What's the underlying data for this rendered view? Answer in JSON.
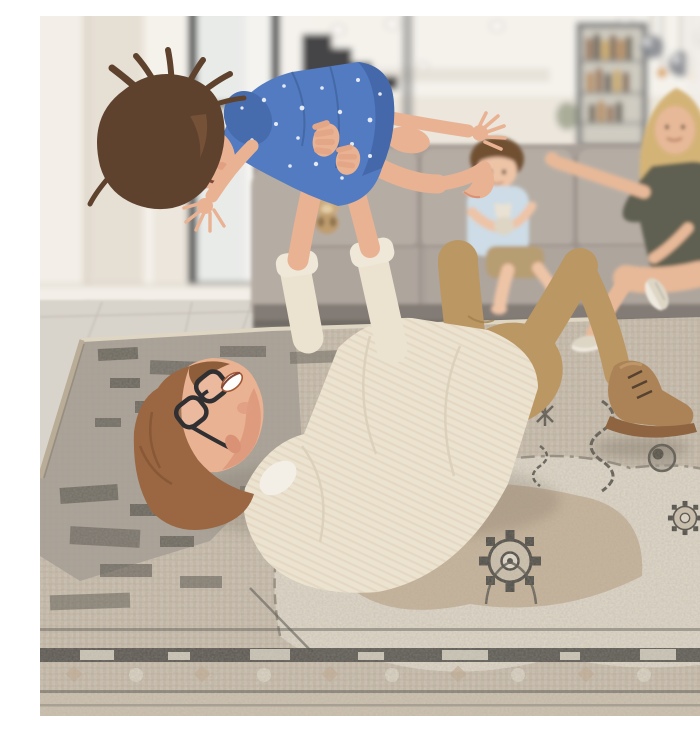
{
  "scene": {
    "caption": "Lifestyle photo: a father lies on his back on a distressed beige-and-grey vintage-style area rug, lifting his laughing daughter in a blue polka-dot dress into the air; a smiling blonde mother and a young boy hugging a teddy bear watch from a grey sofa in a bright modern living room with pendant lights, a drinks cabinet and a dark staircase in the background.",
    "people": [
      "father-lying-on-rug",
      "daughter-lifted-in-air",
      "mother-on-sofa",
      "boy-on-sofa"
    ],
    "objects": [
      "area-rug",
      "grey-sofa",
      "teddy-bear",
      "pendant-lights",
      "bar-cabinet",
      "staircase",
      "window",
      "recessed-ceiling-lights",
      "tile-floor"
    ]
  },
  "colors": {
    "ceiling": "#f6f4ef",
    "wall": "#ece7de",
    "wall_bright": "#f4f1ea",
    "window_frame": "#43464a",
    "glass": "#e9eceb",
    "stairs": "#2c2d31",
    "cabinet_frame": "#77797a",
    "pendant": "#7e838a",
    "bulb": "#d99c3f",
    "floor": "#d7d3cc",
    "sofa": "#a59d96",
    "sofa_light": "#b3aba3",
    "sofa_dark": "#7e7771",
    "sofa_base": "#6b6661",
    "rug_base": "#c8bcaa",
    "rug_field_grey": "#9f998e",
    "rug_cream": "#e4decf",
    "rug_tan": "#c2ab90",
    "rug_dark": "#45433e",
    "skin": "#e9b090",
    "skin_deep": "#d98f72",
    "father_hair": "#96613b",
    "father_shirt": "#ece3d1",
    "father_pants": "#b9945f",
    "belt": "#a05c2a",
    "boot": "#a97f52",
    "daughter_hair": "#573a26",
    "daughter_dress": "#4a76c2",
    "dress_dot": "#e3ebf7",
    "mother_hair": "#d3b273",
    "mother_dress": "#595a4c",
    "boy_shirt": "#ccdde8",
    "boy_shorts": "#b59a6e",
    "teddy_tan": "#c9a97c",
    "teddy_white": "#e9e2d4",
    "sneaker": "#ddd6c6"
  }
}
